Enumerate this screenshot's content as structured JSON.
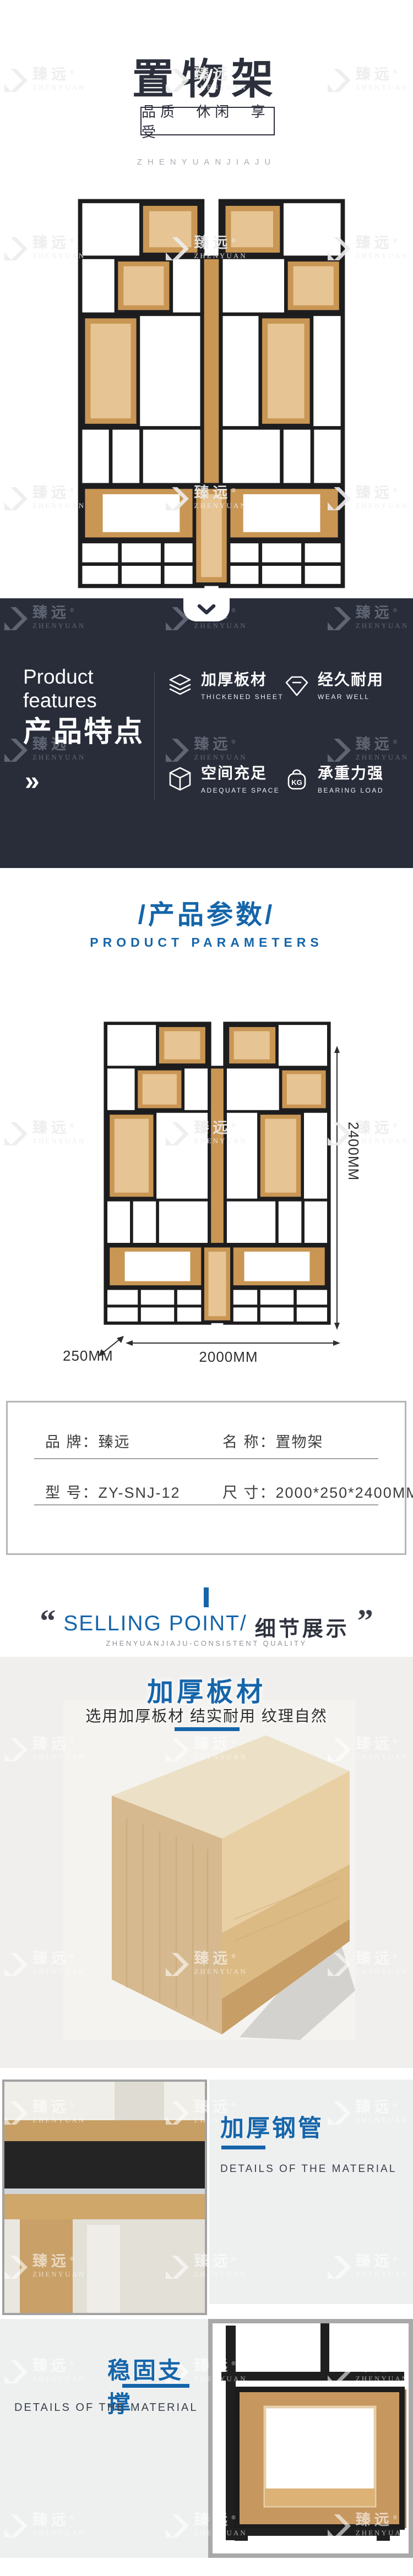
{
  "watermark": {
    "zh": "臻远",
    "en": "ZHENYUAN",
    "reg": "®"
  },
  "header": {
    "title": "置物架",
    "slogan": "品质 休闲 享受",
    "brand_line": "ZHENYUANJIAJU"
  },
  "hero": {
    "scroll_hint_icon": "chevron-down-icon"
  },
  "features": {
    "en_title": "Product features",
    "zh_title": "产品特点",
    "more_arrow": "»",
    "items": [
      {
        "zh": "加厚板材",
        "en": "THICKENED SHEET",
        "icon": "layers-icon"
      },
      {
        "zh": "经久耐用",
        "en": "WEAR WELL",
        "icon": "gem-icon"
      },
      {
        "zh": "空间充足",
        "en": "ADEQUATE SPACE",
        "icon": "cube-icon"
      },
      {
        "zh": "承重力强",
        "en": "BEARING LOAD",
        "icon": "kg-weight-icon"
      }
    ]
  },
  "params": {
    "zh_heading": "/产品参数/",
    "en_heading": "PRODUCT PARAMETERS",
    "height_label": "2400MM",
    "depth_label": "250MM",
    "width_label": "2000MM"
  },
  "spec": {
    "brand_label": "品 牌：",
    "brand_value": "臻远",
    "name_label": "名 称：",
    "name_value": "置物架",
    "model_label": "型 号：",
    "model_value": "ZY-SNJ-12",
    "size_label": "尺 寸：",
    "size_value": "2000*250*2400MM"
  },
  "selling": {
    "quote_open": "“",
    "en": "SELLING POINT/",
    "zh": "细节展示",
    "quote_close": "”",
    "subtitle": "ZHENYUANJIAJU-CONSISTENT QUALITY"
  },
  "detail_a": {
    "title": "加厚板材",
    "desc": "选用加厚板材 结实耐用 纹理自然"
  },
  "detail_b": {
    "title": "加厚钢管",
    "desc": "DETAILS OF THE MATERIAL"
  },
  "detail_c": {
    "title": "稳固支撑",
    "desc": "DETAILS OF THE MATERIAL"
  },
  "colors": {
    "accent": "#1565aa",
    "dark_bg": "#292d3a",
    "frame": "#1d1d1f",
    "wood": "#c99654"
  }
}
